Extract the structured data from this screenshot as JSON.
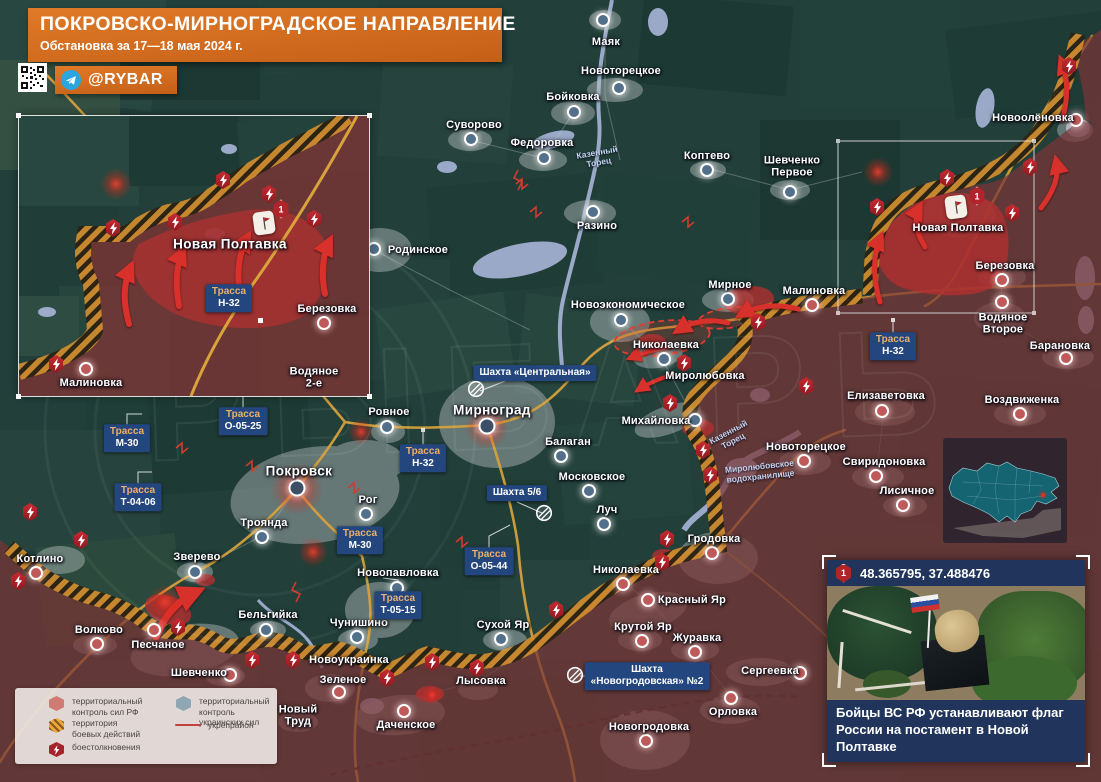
{
  "header": {
    "title": "ПОКРОВСКО-МИРНОГРАДСКОЕ НАПРАВЛЕНИЕ",
    "subtitle": "Обстановка за 17—18 мая 2024 г.",
    "channel": "@RYBAR"
  },
  "colors": {
    "accent": "#d4691e",
    "rf_zone": "#7a3536",
    "combat_zone": "#cf8d2e",
    "ua_zone": "#223f3a",
    "road": "#d9a33c",
    "chip": "#24467e",
    "advance": "#b23030"
  },
  "watermark": "РЫБАРЬ",
  "legend": {
    "items": [
      {
        "type": "rf",
        "label": "территориальный\nконтроль сил РФ",
        "x": 33,
        "y": 8
      },
      {
        "type": "combat",
        "label": "территория\nбоевых действий",
        "x": 33,
        "y": 30
      },
      {
        "type": "battle",
        "label": "боестолкновения",
        "x": 33,
        "y": 54
      },
      {
        "type": "ua",
        "label": "территориальный\nконтроль украинских сил",
        "x": 160,
        "y": 8
      },
      {
        "type": "line",
        "label": "укрепрайон",
        "x": 160,
        "y": 32
      }
    ]
  },
  "map": {
    "towns": [
      {
        "n": "Маяк",
        "x": 603,
        "y": 20,
        "lx": 606,
        "ly": 42,
        "s": "ua"
      },
      {
        "n": "Новоторецкое",
        "x": 619,
        "y": 88,
        "lx": 621,
        "ly": 71,
        "s": "ua"
      },
      {
        "n": "Бойковка",
        "x": 574,
        "y": 112,
        "lx": 573,
        "ly": 97,
        "s": "ua"
      },
      {
        "n": "Суворово",
        "x": 471,
        "y": 139,
        "lx": 474,
        "ly": 125,
        "s": "ua"
      },
      {
        "n": "Федоровка",
        "x": 544,
        "y": 158,
        "lx": 542,
        "ly": 143,
        "s": "ua"
      },
      {
        "n": "Коптево",
        "x": 707,
        "y": 170,
        "lx": 707,
        "ly": 156,
        "s": "ua"
      },
      {
        "n": "Шевченко\nПервое",
        "x": 790,
        "y": 192,
        "lx": 792,
        "ly": 167,
        "s": "ua"
      },
      {
        "n": "Разино",
        "x": 593,
        "y": 212,
        "lx": 597,
        "ly": 226,
        "s": "ua"
      },
      {
        "n": "Родинское",
        "x": 374,
        "y": 249,
        "lx": 418,
        "ly": 250,
        "s": "ua"
      },
      {
        "n": "Новоэкономическое",
        "x": 621,
        "y": 320,
        "lx": 628,
        "ly": 305,
        "s": "ua"
      },
      {
        "n": "Мирное",
        "x": 728,
        "y": 299,
        "lx": 730,
        "ly": 285,
        "s": "ua"
      },
      {
        "n": "Малиновка",
        "x": 812,
        "y": 305,
        "lx": 814,
        "ly": 291,
        "s": "rf"
      },
      {
        "n": "Николаевка",
        "x": 664,
        "y": 359,
        "lx": 666,
        "ly": 345,
        "s": "ua"
      },
      {
        "n": "Миролюбовка",
        "lx": 705,
        "ly": 376,
        "nomark": true
      },
      {
        "n": "Михайловка",
        "x": 695,
        "y": 420,
        "lx": 656,
        "ly": 421,
        "s": "ua"
      },
      {
        "n": "Балаган",
        "x": 561,
        "y": 456,
        "lx": 568,
        "ly": 442,
        "s": "ua"
      },
      {
        "n": "Московское",
        "x": 589,
        "y": 491,
        "lx": 592,
        "ly": 477,
        "s": "ua"
      },
      {
        "n": "Луч",
        "x": 604,
        "y": 524,
        "lx": 607,
        "ly": 510,
        "s": "ua"
      },
      {
        "n": "Мирноград",
        "x": 487,
        "y": 426,
        "lx": 492,
        "ly": 410,
        "s": "ua",
        "big": true
      },
      {
        "n": "Ровное",
        "x": 387,
        "y": 427,
        "lx": 389,
        "ly": 412,
        "s": "ua"
      },
      {
        "n": "Рог",
        "x": 366,
        "y": 514,
        "lx": 368,
        "ly": 500,
        "s": "ua"
      },
      {
        "n": "Покровск",
        "x": 297,
        "y": 488,
        "lx": 299,
        "ly": 471,
        "s": "ua",
        "big": true
      },
      {
        "n": "Троянда",
        "x": 262,
        "y": 537,
        "lx": 264,
        "ly": 523,
        "s": "ua"
      },
      {
        "n": "Зверево",
        "x": 195,
        "y": 572,
        "lx": 197,
        "ly": 557,
        "s": "ua"
      },
      {
        "n": "Котлино",
        "x": 36,
        "y": 573,
        "lx": 40,
        "ly": 559,
        "s": "rf"
      },
      {
        "n": "Новопавловка",
        "x": 397,
        "y": 588,
        "lx": 398,
        "ly": 573,
        "s": "ua"
      },
      {
        "n": "Бельгийка",
        "x": 266,
        "y": 630,
        "lx": 268,
        "ly": 615,
        "s": "ua"
      },
      {
        "n": "Чунишино",
        "x": 357,
        "y": 637,
        "lx": 359,
        "ly": 623,
        "s": "ua"
      },
      {
        "n": "Волково",
        "x": 97,
        "y": 644,
        "lx": 99,
        "ly": 630,
        "s": "rf"
      },
      {
        "n": "Песчаное",
        "x": 154,
        "y": 630,
        "lx": 158,
        "ly": 645,
        "s": "rf"
      },
      {
        "n": "Шевченко",
        "x": 230,
        "y": 675,
        "lx": 199,
        "ly": 673,
        "s": "rf"
      },
      {
        "n": "Новоукраинка",
        "lx": 349,
        "ly": 660,
        "nomark": true
      },
      {
        "n": "Зеленое",
        "x": 339,
        "y": 692,
        "lx": 343,
        "ly": 680,
        "s": "rf"
      },
      {
        "n": "Новый\nТруд",
        "lx": 298,
        "ly": 716,
        "nomark": true
      },
      {
        "n": "Даченское",
        "x": 404,
        "y": 711,
        "lx": 406,
        "ly": 725,
        "s": "rf"
      },
      {
        "n": "Сухой Яр",
        "x": 501,
        "y": 639,
        "lx": 503,
        "ly": 625,
        "s": "ua"
      },
      {
        "n": "Лысовка",
        "lx": 481,
        "ly": 681,
        "nomark": true
      },
      {
        "n": "Красный Яр",
        "x": 648,
        "y": 600,
        "lx": 692,
        "ly": 600,
        "s": "rf"
      },
      {
        "n": "Крутой Яр",
        "x": 642,
        "y": 641,
        "lx": 643,
        "ly": 627,
        "s": "rf"
      },
      {
        "n": "Журавка",
        "x": 695,
        "y": 652,
        "lx": 697,
        "ly": 638,
        "s": "rf"
      },
      {
        "n": "Сергеевка",
        "x": 800,
        "y": 673,
        "lx": 770,
        "ly": 671,
        "s": "rf"
      },
      {
        "n": "Орловка",
        "x": 731,
        "y": 698,
        "lx": 733,
        "ly": 712,
        "s": "rf"
      },
      {
        "n": "Новогродовка",
        "x": 646,
        "y": 741,
        "lx": 649,
        "ly": 727,
        "s": "rf"
      },
      {
        "n": "Гродовка",
        "x": 712,
        "y": 553,
        "lx": 714,
        "ly": 539,
        "s": "rf"
      },
      {
        "n": "Николаевка",
        "x": 623,
        "y": 584,
        "lx": 626,
        "ly": 570,
        "s": "rf"
      },
      {
        "n": "Елизаветовка",
        "x": 882,
        "y": 411,
        "lx": 886,
        "ly": 396,
        "s": "rf"
      },
      {
        "n": "Воздвиженка",
        "x": 1020,
        "y": 414,
        "lx": 1022,
        "ly": 400,
        "s": "rf"
      },
      {
        "n": "Свиридоновка",
        "x": 876,
        "y": 476,
        "lx": 884,
        "ly": 462,
        "s": "rf"
      },
      {
        "n": "Лисичное",
        "x": 903,
        "y": 505,
        "lx": 907,
        "ly": 491,
        "s": "rf"
      },
      {
        "n": "Новоторецкое",
        "x": 804,
        "y": 461,
        "lx": 806,
        "ly": 447,
        "s": "rf"
      },
      {
        "n": "Новоолёновка",
        "x": 1076,
        "y": 120,
        "lx": 1033,
        "ly": 118,
        "s": "rf"
      },
      {
        "n": "Новая Полтавка",
        "lx": 958,
        "ly": 228,
        "nomark": true
      },
      {
        "n": "Березовка",
        "x": 1002,
        "y": 280,
        "lx": 1005,
        "ly": 266,
        "s": "rf"
      },
      {
        "n": "Водяное\nВторое",
        "x": 1002,
        "y": 302,
        "lx": 1003,
        "ly": 324,
        "s": "rf"
      },
      {
        "n": "Барановка",
        "x": 1066,
        "y": 358,
        "lx": 1060,
        "ly": 346,
        "s": "rf"
      }
    ],
    "road_labels": [
      {
        "label": "Трасса",
        "value": "Н-32",
        "x": 423,
        "y": 458
      },
      {
        "label": "Трасса",
        "value": "Н-32",
        "x": 893,
        "y": 346
      },
      {
        "label": "Трасса",
        "value": "М-30",
        "x": 127,
        "y": 438
      },
      {
        "label": "Трасса",
        "value": "М-30",
        "x": 360,
        "y": 540
      },
      {
        "label": "Трасса",
        "value": "О-05-25",
        "x": 243,
        "y": 421
      },
      {
        "label": "Трасса",
        "value": "Т-04-06",
        "x": 138,
        "y": 497
      },
      {
        "label": "Трасса",
        "value": "Т-05-15",
        "x": 398,
        "y": 605
      },
      {
        "label": "Трасса",
        "value": "О-05-44",
        "x": 489,
        "y": 561
      },
      {
        "value": "Шахта «Центральная»",
        "x": 535,
        "y": 373
      },
      {
        "value": "Шахта 5/6",
        "x": 517,
        "y": 493
      },
      {
        "value": "Шахта\n«Новогродовская» №2",
        "x": 647,
        "y": 676
      }
    ],
    "water_labels": [
      {
        "text": "Казенный\nТорец",
        "x": 598,
        "y": 158,
        "rot": -10
      },
      {
        "text": "Казенный\nТорец",
        "x": 731,
        "y": 437,
        "rot": -28
      },
      {
        "text": "Миролюбовское\nводохранилище",
        "x": 760,
        "y": 472,
        "rot": -6
      }
    ],
    "battle_icons": [
      [
        1069,
        66
      ],
      [
        947,
        178
      ],
      [
        1030,
        167
      ],
      [
        877,
        207
      ],
      [
        1012,
        213
      ],
      [
        758,
        322
      ],
      [
        684,
        363
      ],
      [
        806,
        386
      ],
      [
        670,
        403
      ],
      [
        703,
        450
      ],
      [
        710,
        475
      ],
      [
        667,
        539
      ],
      [
        662,
        562
      ],
      [
        556,
        610
      ],
      [
        477,
        668
      ],
      [
        432,
        662
      ],
      [
        387,
        678
      ],
      [
        293,
        660
      ],
      [
        252,
        660
      ],
      [
        178,
        627
      ],
      [
        81,
        540
      ],
      [
        30,
        512
      ],
      [
        18,
        581
      ]
    ],
    "mine_icons": [
      [
        476,
        389
      ],
      [
        544,
        513
      ],
      [
        575,
        675
      ]
    ],
    "flags": [
      {
        "x": 956,
        "y": 207,
        "hx": 977,
        "hy": 196,
        "num": "1"
      }
    ]
  },
  "inset": {
    "towns": [
      {
        "n": "Новая Полтавка",
        "lx": 211,
        "ly": 128,
        "nomark": true,
        "big": true
      },
      {
        "n": "Березовка",
        "x": 305,
        "y": 207,
        "lx": 308,
        "ly": 193,
        "s": "rf"
      },
      {
        "n": "Водяное 2-е",
        "lx": 295,
        "ly": 262,
        "nomark": true
      },
      {
        "n": "Малиновка",
        "x": 67,
        "y": 253,
        "lx": 72,
        "ly": 267,
        "s": "rf"
      }
    ],
    "road_labels": [
      {
        "label": "Трасса",
        "value": "Н-32",
        "x": 210,
        "y": 182
      }
    ],
    "battle_icons": [
      [
        204,
        64
      ],
      [
        250,
        78
      ],
      [
        156,
        106
      ],
      [
        94,
        112
      ],
      [
        295,
        103
      ],
      [
        37,
        248
      ]
    ],
    "flags": [
      {
        "x": 245,
        "y": 107,
        "hx": 262,
        "hy": 93,
        "num": "1"
      }
    ]
  },
  "photo": {
    "num": "1",
    "coords": "48.365795, 37.488476",
    "caption": "Бойцы ВС РФ устанавливают флаг\nРоссии на постамент в Новой Полтавке"
  }
}
